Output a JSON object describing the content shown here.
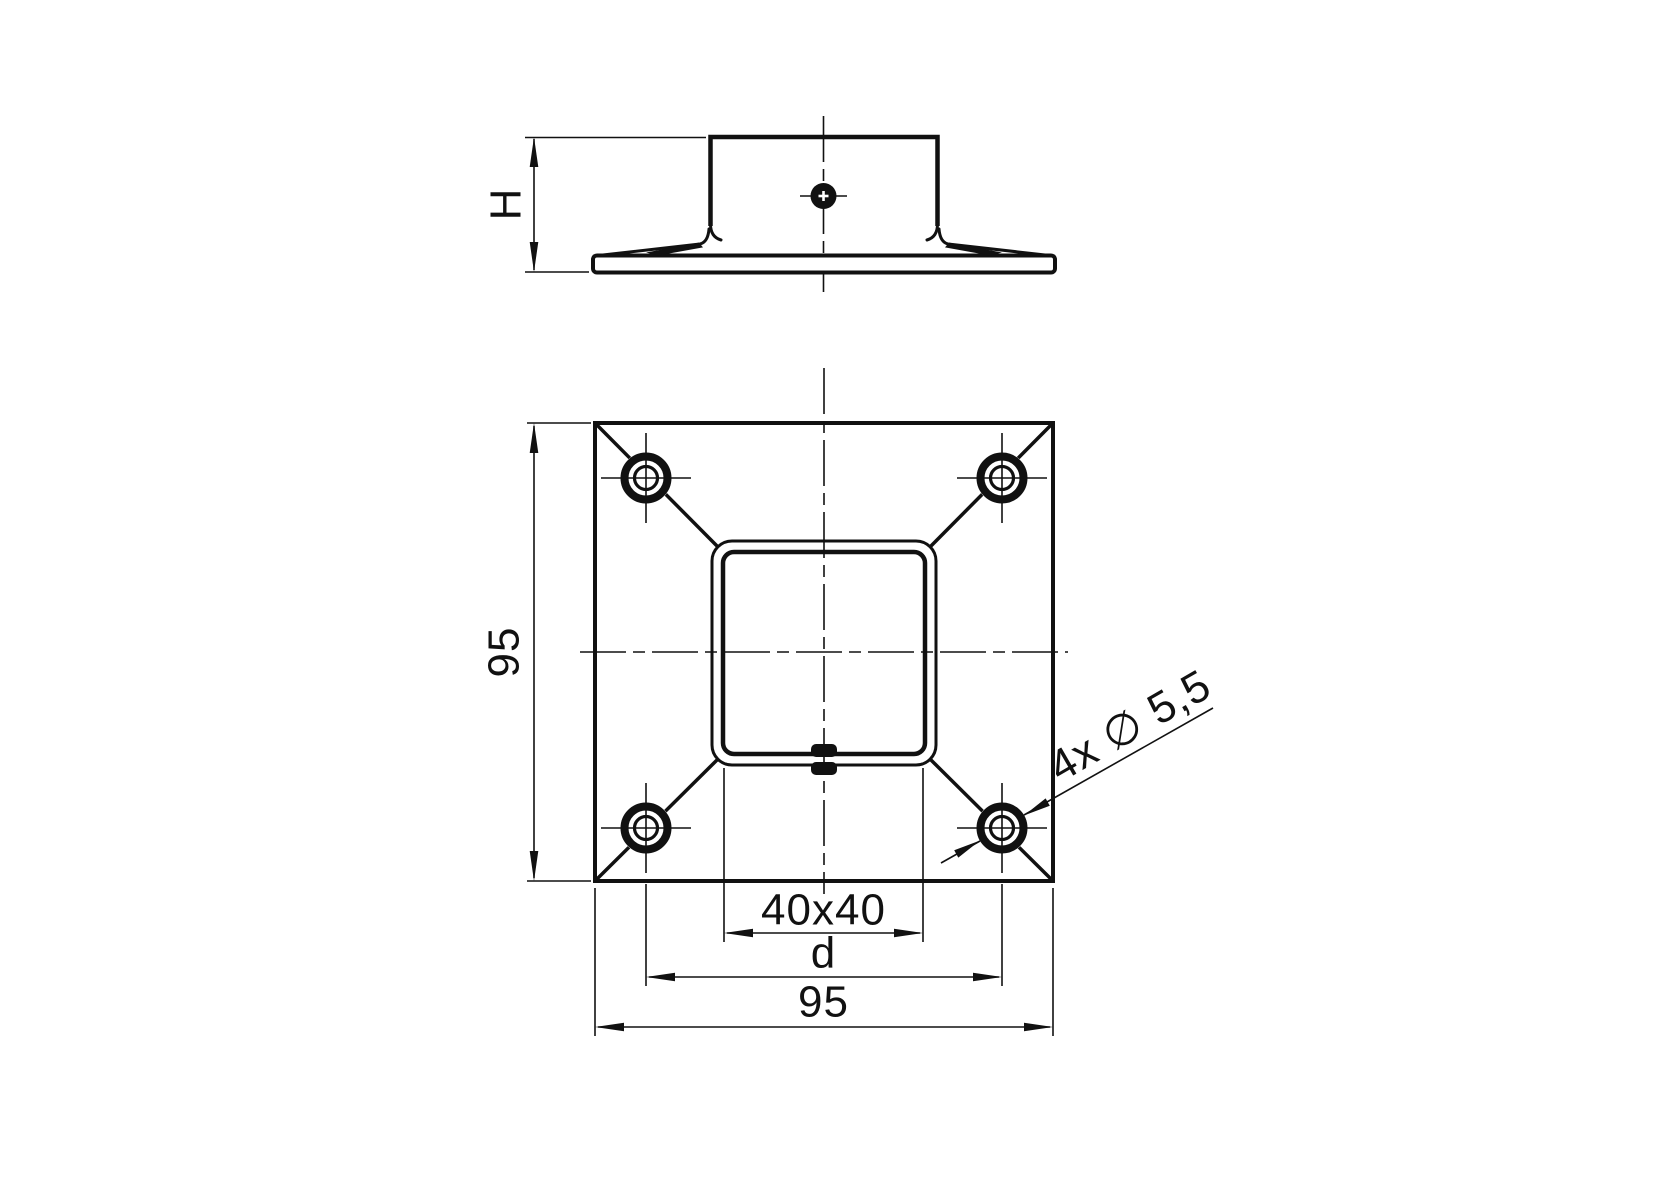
{
  "drawing": {
    "colors": {
      "line": "#111111",
      "background": "#ffffff"
    },
    "side_view": {
      "height_dim_label": "H"
    },
    "plan_view": {
      "plate_height_dim_label": "95",
      "tube_dim_label": "40x40",
      "hole_spacing_dim_label": "d",
      "plate_width_dim_label": "95",
      "holes_count_dia_label": "4x ∅ 5,5"
    }
  }
}
